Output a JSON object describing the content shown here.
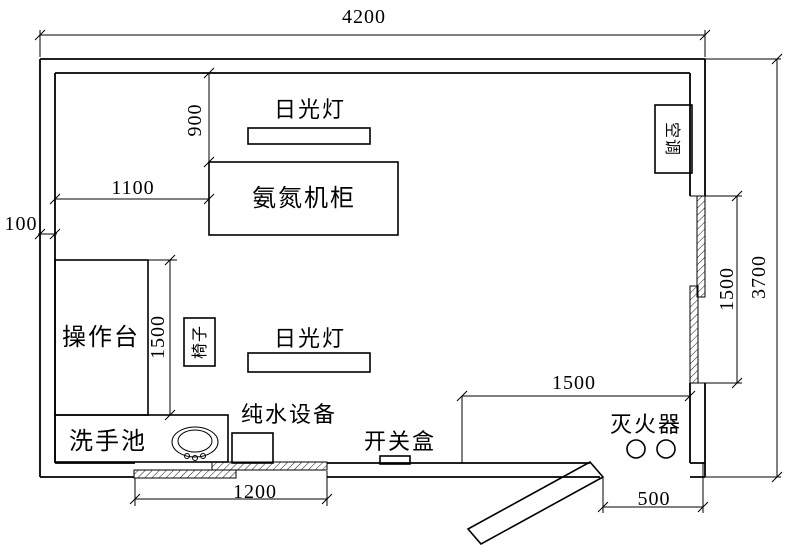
{
  "drawing": {
    "type": "room-floor-plan",
    "background": "#ffffff",
    "line_color": "#000000"
  },
  "labels": {
    "fluorescent_lamp_top": "日光灯",
    "ammonia_nitrogen_cabinet": "氨氮机柜",
    "air_conditioner": "空调",
    "workbench": "操作台",
    "chair": "椅子",
    "fluorescent_lamp_bottom": "日光灯",
    "wash_basin": "洗手池",
    "pure_water_equipment": "纯水设备",
    "switch_box": "开关盒",
    "fire_extinguisher": "灭火器"
  },
  "dimensions": {
    "room_width": "4200",
    "room_height": "3700",
    "wall_thickness": "100",
    "cabinet_left_offset": "1100",
    "lamp_top_offset": "900",
    "right_window_length": "1500",
    "workbench_length": "1500",
    "door_zone_width": "1500",
    "bottom_window_width": "1200",
    "door_width": "500"
  }
}
